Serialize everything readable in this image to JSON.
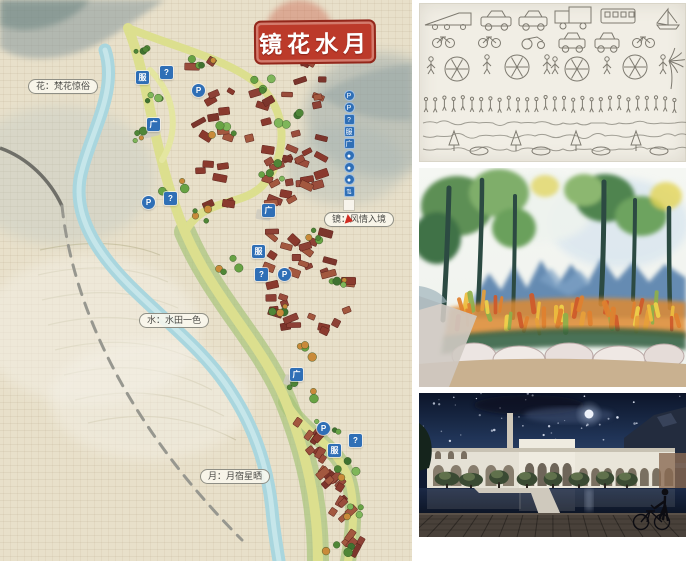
{
  "map": {
    "seal_title": "镜花水月",
    "labels": {
      "flower": "花：梵花惊俗",
      "mirror": "镜：风情入境",
      "water": "水：水田一色",
      "moon": "月：月宿星晒"
    },
    "markers": [
      {
        "t": "服",
        "s": "sq",
        "x": 136,
        "y": 71
      },
      {
        "t": "?",
        "s": "sq",
        "x": 160,
        "y": 66
      },
      {
        "t": "P",
        "s": "ci",
        "x": 192,
        "y": 84
      },
      {
        "t": "广",
        "s": "sq",
        "x": 147,
        "y": 118
      },
      {
        "t": "P",
        "s": "ci",
        "x": 142,
        "y": 196
      },
      {
        "t": "?",
        "s": "sq",
        "x": 164,
        "y": 192
      },
      {
        "t": "广",
        "s": "sq",
        "x": 262,
        "y": 204
      },
      {
        "t": "服",
        "s": "sq",
        "x": 252,
        "y": 245
      },
      {
        "t": "?",
        "s": "sq",
        "x": 255,
        "y": 268
      },
      {
        "t": "P",
        "s": "ci",
        "x": 278,
        "y": 268
      },
      {
        "t": "广",
        "s": "sq",
        "x": 290,
        "y": 368
      },
      {
        "t": "P",
        "s": "ci",
        "x": 317,
        "y": 422
      },
      {
        "t": "服",
        "s": "sq",
        "x": 328,
        "y": 444
      },
      {
        "t": "?",
        "s": "sq",
        "x": 349,
        "y": 434
      }
    ],
    "legend_items": [
      {
        "t": "P",
        "s": "ci"
      },
      {
        "t": "P",
        "s": "ci"
      },
      {
        "t": "?",
        "s": "sq"
      },
      {
        "t": "服",
        "s": "sq"
      },
      {
        "t": "广",
        "s": "sq"
      },
      {
        "t": "●",
        "s": "ci"
      },
      {
        "t": "●",
        "s": "ci"
      },
      {
        "t": "●",
        "s": "ci"
      },
      {
        "t": "⇅",
        "s": "sq"
      }
    ],
    "colors": {
      "canvas": "#e8e0ca",
      "seal_red": "#bc3a2a",
      "marker_blue": "#2f6fb6",
      "river": "#a9d6de",
      "road_yellow": "#dcdf8e",
      "building_red": "#8d4136"
    }
  },
  "sketch": {
    "paper": "#f1eee5",
    "ink": "#6a665c"
  },
  "painting": {
    "sky": "#f5f7f3",
    "mountain_blue": "#4e79a8",
    "flower_orange": "#e0812f"
  },
  "photo": {
    "sky": "#13203c",
    "building": "#e9e5da",
    "deck": "#49413a"
  }
}
